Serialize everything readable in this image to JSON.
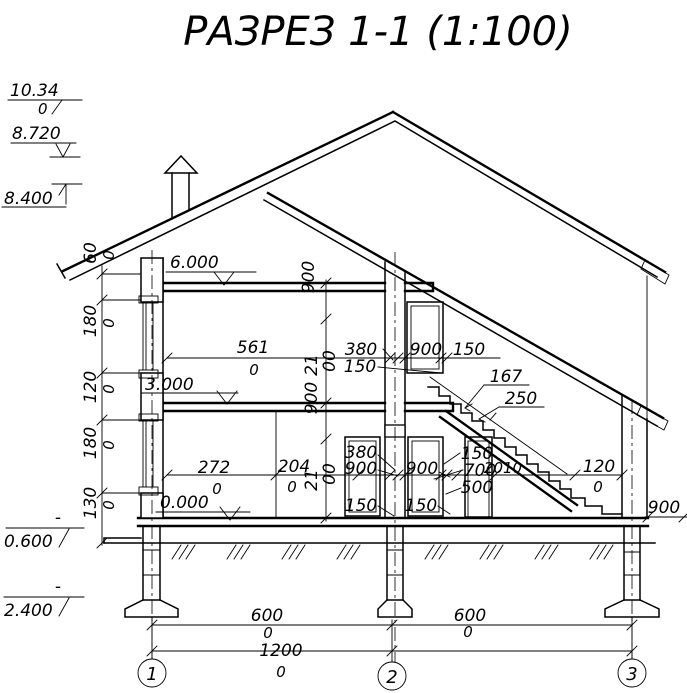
{
  "title": "РАЗРЕЗ 1-1 (1:100)",
  "levels": {
    "l1034": {
      "main": "10.34",
      "wrap": "0"
    },
    "l8720": "8.720",
    "l8400": "8.400",
    "l6000": "6.000",
    "l3000": "3.000",
    "l0000": "0.000",
    "l0600": {
      "sign": "-",
      "value": "0.600"
    },
    "l2400": {
      "sign": "-",
      "value": "2.400"
    }
  },
  "left_chain": [
    {
      "v": "60",
      "z": "0"
    },
    {
      "v": "180",
      "z": "0"
    },
    {
      "v": "120",
      "z": "0"
    },
    {
      "v": "180",
      "z": "0"
    },
    {
      "v": "130",
      "z": "0"
    }
  ],
  "height_chain": {
    "t900": "900",
    "u21": "21",
    "u00": "00",
    "m900": "900",
    "d21": "21",
    "d00": "00"
  },
  "sf": {
    "d561": {
      "v": "561",
      "z": "0"
    },
    "w380": "380",
    "w150a": "150",
    "w900": "900",
    "w150b": "150"
  },
  "ff": {
    "d272": {
      "v": "272",
      "z": "0"
    },
    "d204": {
      "v": "204",
      "z": "0"
    },
    "l380": "380",
    "l900": "900",
    "l150": "150",
    "r900": "900",
    "r150": "150",
    "s150": "150",
    "s700": "700",
    "s500": "500",
    "d2010": "2010",
    "d120": {
      "v": "120",
      "z": "0"
    },
    "out900": "900"
  },
  "stair": {
    "riser": "167",
    "tread": "250"
  },
  "bottom": {
    "b600a": {
      "v": "600",
      "z": "0"
    },
    "b600b": {
      "v": "600",
      "z": "0"
    },
    "b12000": {
      "v": "1200",
      "z": "0"
    }
  },
  "axes": [
    {
      "n": "1"
    },
    {
      "n": "2"
    },
    {
      "n": "3"
    }
  ]
}
